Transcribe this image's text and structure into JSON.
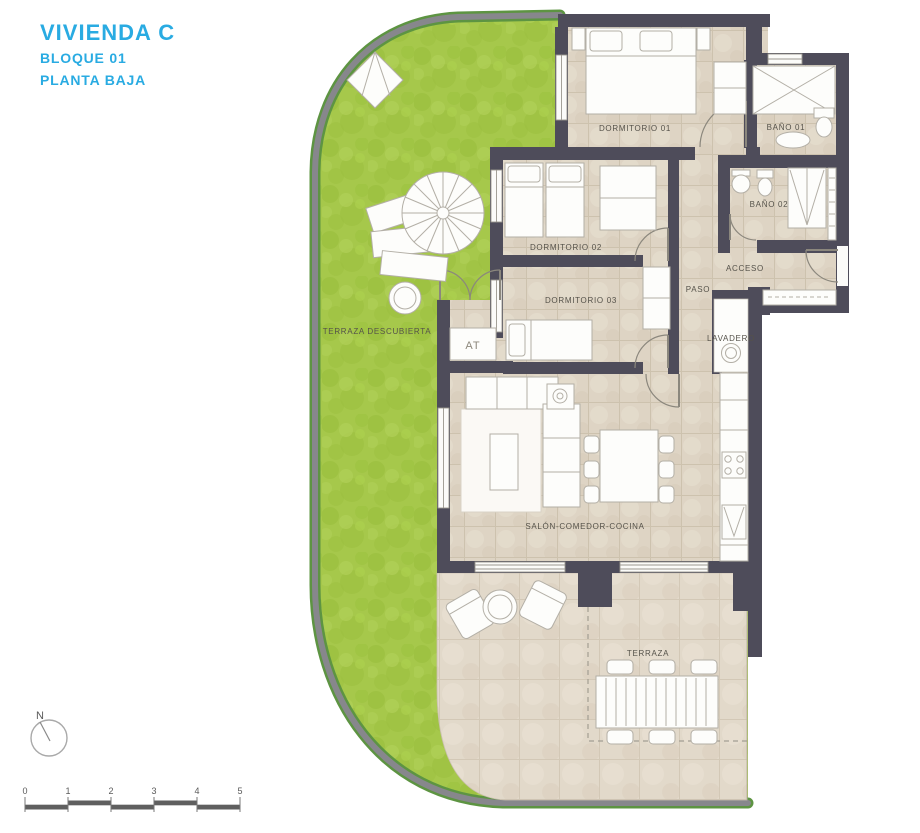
{
  "title_block": {
    "title": "VIVIENDA C",
    "block": "BLOQUE 01",
    "floor": "PLANTA BAJA"
  },
  "rooms": {
    "dormitorio01": "DORMITORIO 01",
    "bano01": "BAÑO 01",
    "bano02": "BAÑO 02",
    "acceso": "ACCESO",
    "paso": "PASO",
    "dormitorio02": "DORMITORIO 02",
    "dormitorio03": "DORMITORIO 03",
    "lavadero": "LAVADERO",
    "terraza_descubierta": "TERRAZA DESCUBIERTA",
    "at": "AT",
    "salon": "SALÓN-COMEDOR-COCINA",
    "terraza": "TERRAZA"
  },
  "compass": {
    "north": "N"
  },
  "scale_bar": {
    "labels": [
      "0",
      "1",
      "2",
      "3",
      "4",
      "5"
    ]
  },
  "colors": {
    "accent": "#29abe2",
    "wall": "#4e4c5a",
    "grass": "#a6c84b",
    "floor_tile": "#ded4c4",
    "terrace_tile": "#e2d9ca",
    "boundary_gray": "#87878c",
    "boundary_green": "#5d9442"
  }
}
